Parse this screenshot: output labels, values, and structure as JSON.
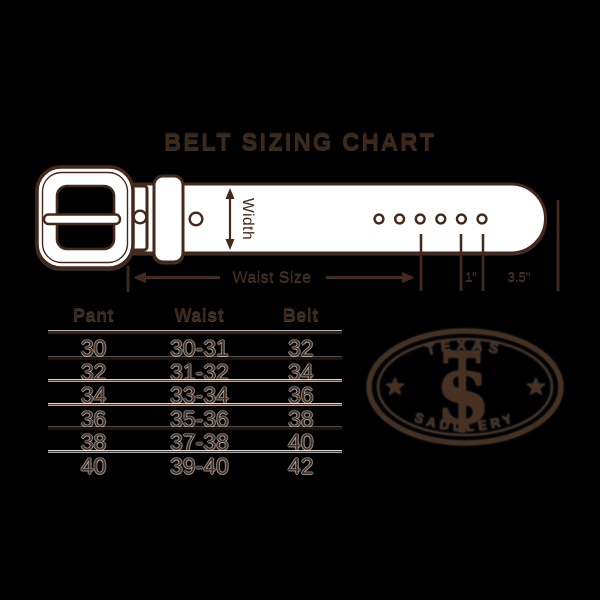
{
  "title": "BELT SIZING CHART",
  "diagram": {
    "width_label": "Width",
    "waist_label": "Waist Size",
    "hole_spacing_label": "1\"",
    "tip_length_label": "3.5\""
  },
  "table": {
    "headers": [
      "Pant",
      "Waist",
      "Belt"
    ],
    "rows": [
      {
        "pant": "30",
        "waist": "30-31",
        "belt": "32"
      },
      {
        "pant": "32",
        "waist": "31-32",
        "belt": "34"
      },
      {
        "pant": "34",
        "waist": "33-34",
        "belt": "36"
      },
      {
        "pant": "36",
        "waist": "35-36",
        "belt": "38"
      },
      {
        "pant": "38",
        "waist": "37-38",
        "belt": "40"
      },
      {
        "pant": "40",
        "waist": "39-40",
        "belt": "42"
      }
    ]
  },
  "logo": {
    "top_text": "TEXAS",
    "bottom_text": "SADDLERY",
    "monogram_letter": "S",
    "star_glyph": "★"
  },
  "colors": {
    "background": "#000000",
    "brown": "#44291b",
    "belt_fill": "#ffffff"
  }
}
